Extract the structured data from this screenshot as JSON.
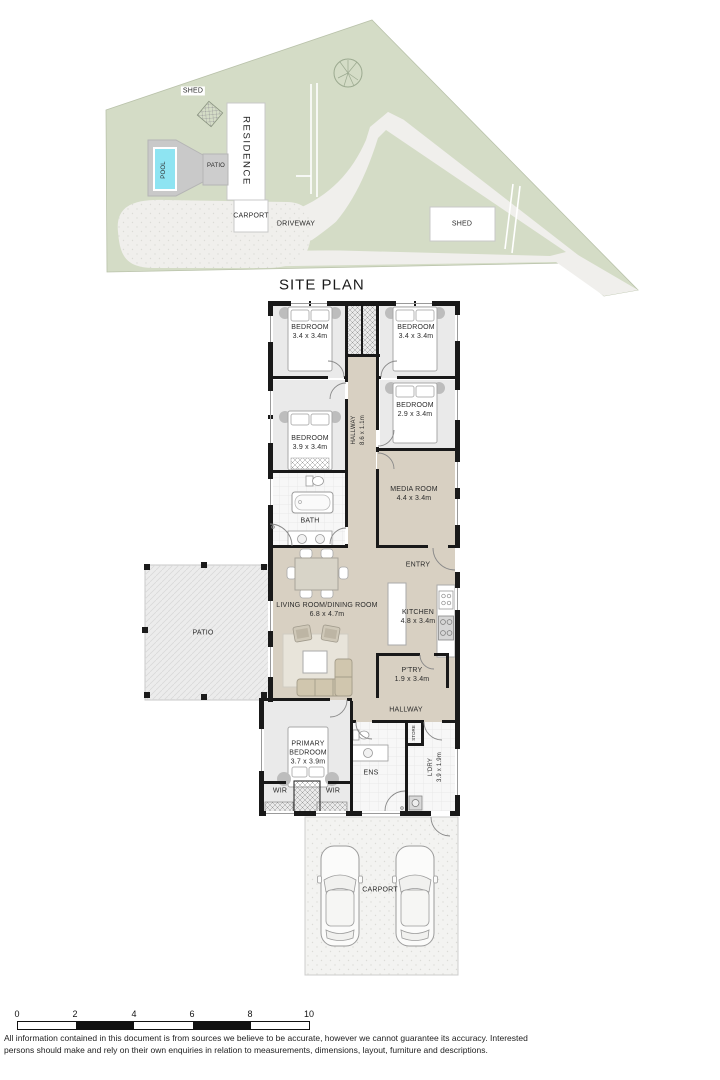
{
  "site_plan": {
    "title": "SITE PLAN",
    "labels": {
      "shed_left": "SHED",
      "pool": "POOL",
      "patio": "PATIO",
      "residence": "RESIDENCE",
      "carport": "CARPORT",
      "driveway": "DRIVEWAY",
      "shed_right": "SHED"
    }
  },
  "floor_plan": {
    "bedroom_top_left": {
      "name": "BEDROOM",
      "dims": "3.4 x 3.4m"
    },
    "bedroom_top_right": {
      "name": "BEDROOM",
      "dims": "3.4 x 3.4m"
    },
    "bedroom_right": {
      "name": "BEDROOM",
      "dims": "2.9 x 3.4m"
    },
    "bedroom_left": {
      "name": "BEDROOM",
      "dims": "3.9 x 3.4m"
    },
    "hallway_main": {
      "name": "HALLWAY",
      "dims": "8.6 x 1.1m"
    },
    "media_room": {
      "name": "MEDIA ROOM",
      "dims": "4.4 x 3.4m"
    },
    "bath": {
      "name": "BATH"
    },
    "entry": {
      "name": "ENTRY"
    },
    "living": {
      "name": "LIVING ROOM/DINING ROOM",
      "dims": "6.8 x 4.7m"
    },
    "kitchen": {
      "name": "KITCHEN",
      "dims": "4.8 x 3.4m"
    },
    "pantry": {
      "name": "P'TRY",
      "dims": "1.9 x 3.4m"
    },
    "hallway_rear": {
      "name": "HALLWAY"
    },
    "patio": {
      "name": "PATIO"
    },
    "primary_bedroom": {
      "name": "PRIMARY BEDROOM",
      "dims": "3.7 x 3.9m"
    },
    "wir_left": {
      "name": "WIR"
    },
    "wir_right": {
      "name": "WIR"
    },
    "ensuite": {
      "name": "ENS"
    },
    "store": {
      "name": "STORE"
    },
    "laundry": {
      "name": "L'DRY",
      "dims": "3.9 x 1.9m"
    },
    "carport": {
      "name": "CARPORT"
    }
  },
  "scale_bar": {
    "ticks": [
      "0",
      "2",
      "4",
      "6",
      "8",
      "10"
    ]
  },
  "disclaimer": {
    "line1": "All information contained in this document is from sources we believe to be accurate, however we cannot guarantee its accuracy. Interested",
    "line2": "persons should make and rely on their own enquiries in relation to measurements, dimensions, layout, furniture and descriptions."
  },
  "colors": {
    "site_green": "#d4dcc6",
    "driveway": "#f0efec",
    "floor_beige": "#d8d0c2",
    "room_gray": "#eaeaea",
    "tile_white": "#f7f7f7",
    "wall": "#191919",
    "pool_blue": "#8ee4f2"
  }
}
